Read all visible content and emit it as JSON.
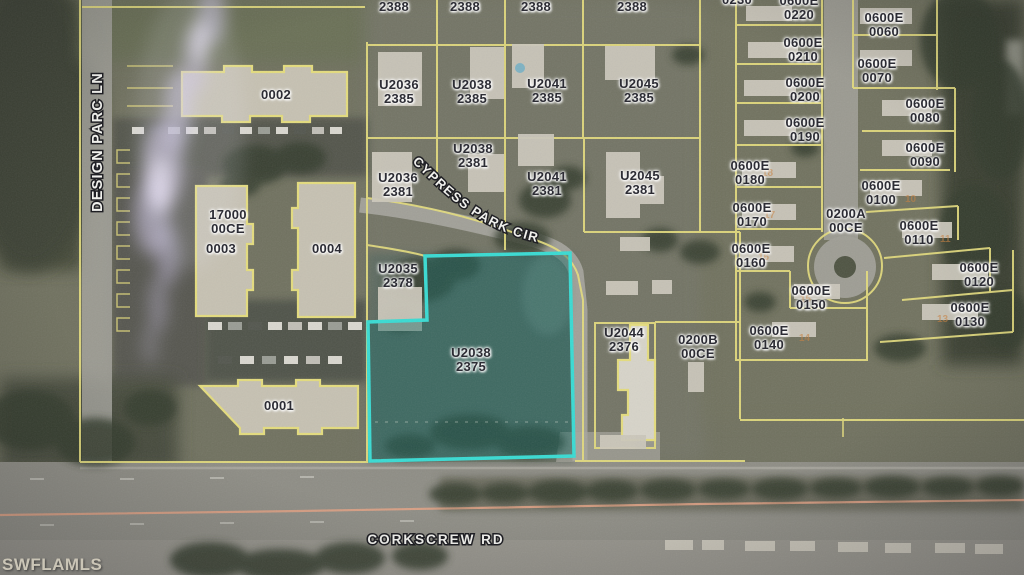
{
  "map": {
    "watermark": "SWFLAMLS",
    "streets": {
      "vertical": "DESIGN PARC LN",
      "curved": "CYPRESS PARK CIR",
      "bottom": "CORKSCREW RD"
    },
    "highlight": {
      "parcel": "U2038",
      "number": "2375",
      "color": "#38dbd3"
    },
    "colors": {
      "parcel_line": "#e4dc7d",
      "highlight": "#38dbd3",
      "label_text": "#2c2c34",
      "street_text": "#f4f4f0",
      "centerline": "#dfa184"
    },
    "labels": [
      {
        "line1": "2388"
      },
      {
        "line1": "2388"
      },
      {
        "line1": "2388"
      },
      {
        "line1": "2388"
      },
      {
        "line1": "U2036",
        "line2": "2385"
      },
      {
        "line1": "U2038",
        "line2": "2385"
      },
      {
        "line1": "U2041",
        "line2": "2385"
      },
      {
        "line1": "U2045",
        "line2": "2385"
      },
      {
        "line1": "U2038",
        "line2": "2381"
      },
      {
        "line1": "U2036",
        "line2": "2381"
      },
      {
        "line1": "U2041",
        "line2": "2381"
      },
      {
        "line1": "U2045",
        "line2": "2381"
      },
      {
        "line1": "U2035",
        "line2": "2378"
      },
      {
        "line1": "U2038",
        "line2": "2375"
      },
      {
        "line1": "U2044",
        "line2": "2376"
      },
      {
        "line1": "0200B",
        "line2": "00CE"
      },
      {
        "line1": "0002"
      },
      {
        "line1": "17000",
        "line2": "00CE"
      },
      {
        "line1": "0003"
      },
      {
        "line1": "0004"
      },
      {
        "line1": "0001"
      },
      {
        "line1": "0230"
      },
      {
        "line1": "0600E",
        "line2": "0220"
      },
      {
        "line1": "0600E",
        "line2": "0210"
      },
      {
        "line1": "0600E",
        "line2": "0200"
      },
      {
        "line1": "0600E",
        "line2": "0190"
      },
      {
        "line1": "0600E",
        "line2": "0180"
      },
      {
        "line1": "0600E",
        "line2": "0170"
      },
      {
        "line1": "0600E",
        "line2": "0160"
      },
      {
        "line1": "0600E",
        "line2": "0150"
      },
      {
        "line1": "0600E",
        "line2": "0140"
      },
      {
        "line1": "0600E",
        "line2": "0060"
      },
      {
        "line1": "0600E",
        "line2": "0070"
      },
      {
        "line1": "0600E",
        "line2": "0080"
      },
      {
        "line1": "0600E",
        "line2": "0090"
      },
      {
        "line1": "0600E",
        "line2": "0100"
      },
      {
        "line1": "0600E",
        "line2": "0110"
      },
      {
        "line1": "0600E",
        "line2": "0120"
      },
      {
        "line1": "0600E",
        "line2": "0130"
      },
      {
        "line1": "0200A",
        "line2": "00CE"
      }
    ],
    "unit_markers": [
      "18",
      "17",
      "16",
      "15",
      "14",
      "10",
      "11",
      "13"
    ]
  }
}
